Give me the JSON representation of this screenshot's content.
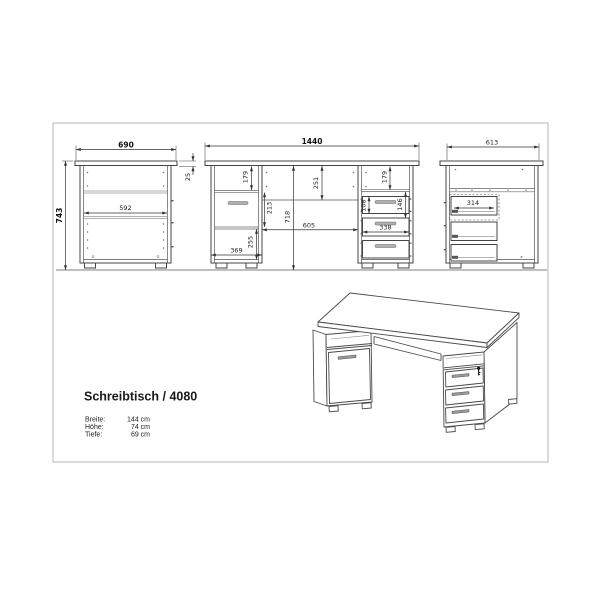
{
  "drawing": {
    "title": "Schreibtisch / 4080",
    "specs": [
      {
        "label": "Breite:",
        "value": "144 cm"
      },
      {
        "label": "Höhe:",
        "value": "74 cm"
      },
      {
        "label": "Tiefe:",
        "value": "69 cm"
      }
    ],
    "views": {
      "left_side": {
        "overall_width": "690",
        "overall_height": "743",
        "interior_width": "592",
        "top_thickness": "25"
      },
      "front": {
        "overall_width": "1440",
        "shelf_height_left": "179",
        "door_height": "213",
        "lower_height": "255",
        "pedestal_width": "369",
        "knee_opening_height": "251",
        "interior_height": "718",
        "knee_opening_width": "605",
        "shelf_height_right": "179",
        "drawer_front_height": "108",
        "drawer_pitch": "146",
        "drawer_width": "338"
      },
      "right_side": {
        "overall_depth": "613",
        "drawer_depth": "314"
      }
    }
  },
  "colors": {
    "line": "#444444",
    "dimension": "#333333",
    "frame": "#b6b6b6",
    "shelf": "#999999",
    "handle": "#b0b0b0",
    "background": "#ffffff"
  }
}
